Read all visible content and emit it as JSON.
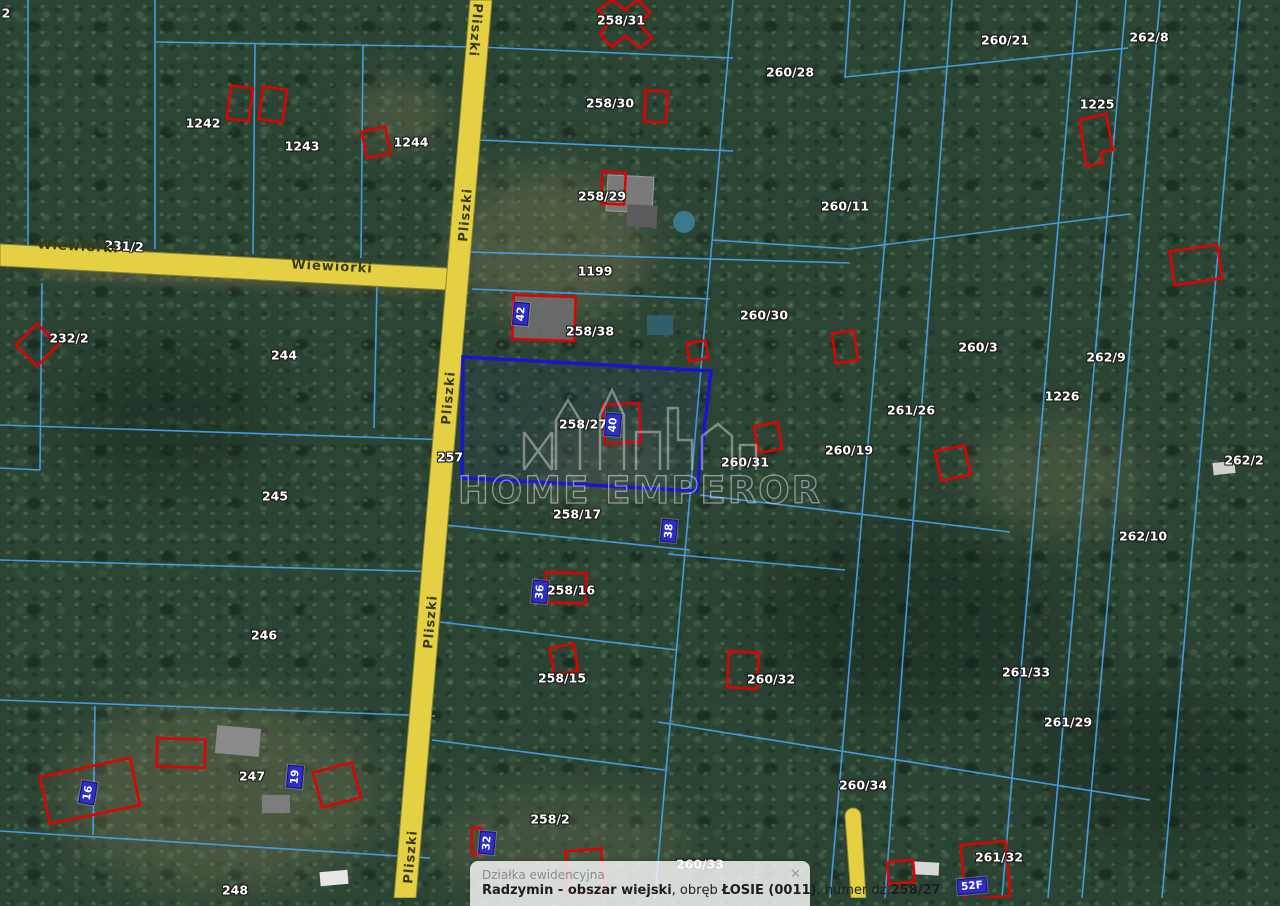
{
  "map": {
    "watermark_text": "HOME EMPEROR",
    "selected_parcel": "258/27",
    "colors": {
      "parcel_line": "#47a0e6",
      "selection_outline": "#1616d0",
      "building_outline": "#e30000",
      "road_fill": "#e4d042",
      "road_border": "#8a8530",
      "plate_background": "#2e2ec4",
      "label_text": "#ffffff",
      "road_label_text": "#3a3a08"
    },
    "road_names": [
      "Wiewiórki",
      "Pliszki"
    ],
    "parcel_labels": [
      {
        "text": "2",
        "x": 6,
        "y": 13,
        "rot": 0
      },
      {
        "text": "1242",
        "x": 203,
        "y": 123,
        "rot": 0
      },
      {
        "text": "1243",
        "x": 302,
        "y": 146,
        "rot": 0
      },
      {
        "text": "1244",
        "x": 411,
        "y": 142,
        "rot": 0
      },
      {
        "text": "258/31",
        "x": 621,
        "y": 20,
        "rot": 0
      },
      {
        "text": "258/30",
        "x": 610,
        "y": 103,
        "rot": 0
      },
      {
        "text": "258/29",
        "x": 602,
        "y": 196,
        "rot": 0
      },
      {
        "text": "260/28",
        "x": 790,
        "y": 72,
        "rot": 0
      },
      {
        "text": "260/21",
        "x": 1005,
        "y": 40,
        "rot": 0
      },
      {
        "text": "260/11",
        "x": 845,
        "y": 206,
        "rot": 0
      },
      {
        "text": "262/8",
        "x": 1149,
        "y": 37,
        "rot": 0
      },
      {
        "text": "1225",
        "x": 1097,
        "y": 104,
        "rot": 0
      },
      {
        "text": "231/2",
        "x": 124,
        "y": 246,
        "rot": 3
      },
      {
        "text": "232/2",
        "x": 69,
        "y": 338,
        "rot": 0
      },
      {
        "text": "244",
        "x": 284,
        "y": 355,
        "rot": 0
      },
      {
        "text": "1199",
        "x": 595,
        "y": 271,
        "rot": 0
      },
      {
        "text": "258/38",
        "x": 590,
        "y": 331,
        "rot": 0
      },
      {
        "text": "260/30",
        "x": 764,
        "y": 315,
        "rot": 0
      },
      {
        "text": "260/3",
        "x": 978,
        "y": 347,
        "rot": 0
      },
      {
        "text": "262/9",
        "x": 1106,
        "y": 357,
        "rot": 0
      },
      {
        "text": "1226",
        "x": 1062,
        "y": 396,
        "rot": 0
      },
      {
        "text": "261/26",
        "x": 911,
        "y": 410,
        "rot": 0
      },
      {
        "text": "262/2",
        "x": 1244,
        "y": 460,
        "rot": 0
      },
      {
        "text": "257",
        "x": 450,
        "y": 457,
        "rot": 0
      },
      {
        "text": "245",
        "x": 275,
        "y": 496,
        "rot": 0
      },
      {
        "text": "258/27",
        "x": 583,
        "y": 424,
        "rot": 0
      },
      {
        "text": "260/31",
        "x": 745,
        "y": 462,
        "rot": 0
      },
      {
        "text": "260/19",
        "x": 849,
        "y": 450,
        "rot": 0
      },
      {
        "text": "258/17",
        "x": 577,
        "y": 514,
        "rot": 0
      },
      {
        "text": "262/10",
        "x": 1143,
        "y": 536,
        "rot": 0
      },
      {
        "text": "258/16",
        "x": 571,
        "y": 590,
        "rot": 0
      },
      {
        "text": "246",
        "x": 264,
        "y": 635,
        "rot": 0
      },
      {
        "text": "258/15",
        "x": 562,
        "y": 678,
        "rot": 0
      },
      {
        "text": "260/32",
        "x": 771,
        "y": 679,
        "rot": 0
      },
      {
        "text": "261/33",
        "x": 1026,
        "y": 672,
        "rot": 0
      },
      {
        "text": "261/29",
        "x": 1068,
        "y": 722,
        "rot": 0
      },
      {
        "text": "260/34",
        "x": 863,
        "y": 785,
        "rot": 0
      },
      {
        "text": "247",
        "x": 252,
        "y": 776,
        "rot": 0
      },
      {
        "text": "248",
        "x": 235,
        "y": 890,
        "rot": 0
      },
      {
        "text": "258/2",
        "x": 550,
        "y": 819,
        "rot": 0
      },
      {
        "text": "260/33",
        "x": 700,
        "y": 864,
        "rot": 0
      },
      {
        "text": "261/32",
        "x": 999,
        "y": 857,
        "rot": 0
      }
    ],
    "road_labels": [
      {
        "text": "Wiewiórki",
        "x": 78,
        "y": 247,
        "rot": 3
      },
      {
        "text": "Wiewiórki",
        "x": 332,
        "y": 267,
        "rot": 3
      },
      {
        "text": "Pliszki",
        "x": 475,
        "y": 30,
        "rot": 95
      },
      {
        "text": "Pliszki",
        "x": 466,
        "y": 215,
        "rot": -85
      },
      {
        "text": "Pliszki",
        "x": 449,
        "y": 398,
        "rot": -85
      },
      {
        "text": "Pliszki",
        "x": 431,
        "y": 622,
        "rot": -85
      },
      {
        "text": "Pliszki",
        "x": 411,
        "y": 857,
        "rot": -85
      }
    ],
    "address_plates": [
      {
        "text": "42",
        "x": 521,
        "y": 314,
        "rot": -85
      },
      {
        "text": "40",
        "x": 613,
        "y": 425,
        "rot": -85
      },
      {
        "text": "38",
        "x": 669,
        "y": 531,
        "rot": -85
      },
      {
        "text": "36",
        "x": 540,
        "y": 592,
        "rot": -85
      },
      {
        "text": "16",
        "x": 88,
        "y": 793,
        "rot": -80
      },
      {
        "text": "19",
        "x": 295,
        "y": 777,
        "rot": -85
      },
      {
        "text": "32",
        "x": 487,
        "y": 843,
        "rot": -85
      },
      {
        "text": "52F",
        "x": 972,
        "y": 886,
        "rot": -5
      }
    ]
  },
  "popup": {
    "title": "Działka ewidencyjna",
    "close_icon": "✕",
    "parts": [
      {
        "text": "Radzymin - obszar wiejski",
        "bold": true
      },
      {
        "text": ", obręb ",
        "bold": false
      },
      {
        "text": "ŁOSIE (0011)",
        "bold": true
      },
      {
        "text": ", numer dz.",
        "bold": false
      },
      {
        "text": "258/27",
        "bold": true
      }
    ]
  }
}
